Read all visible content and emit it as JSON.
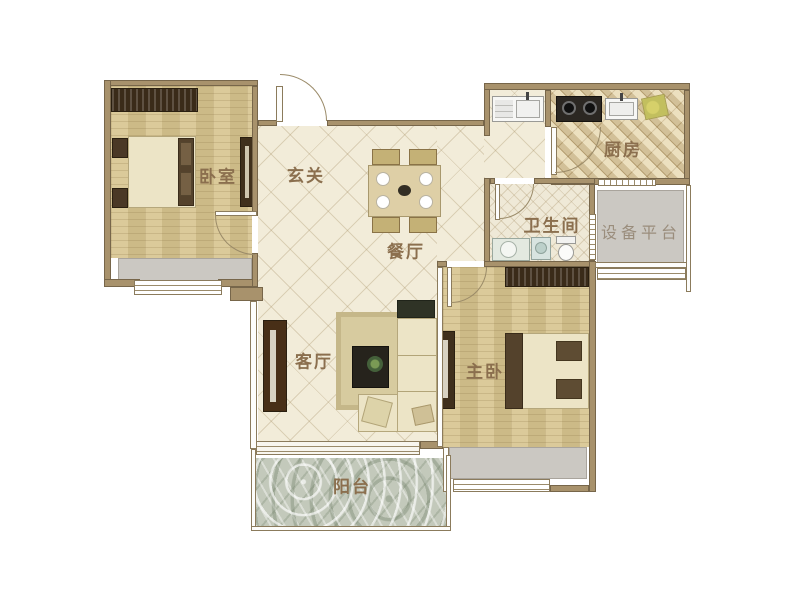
{
  "page": {
    "background": "#ffffff",
    "description": "residential apartment floor plan"
  },
  "labels": {
    "bedroom": "卧室",
    "entry": "玄关",
    "dining": "餐厅",
    "kitchen": "厨房",
    "bathroom": "卫生间",
    "equipment_platform": "设备平台",
    "living": "客厅",
    "master_bedroom": "主卧",
    "balcony": "阳台"
  },
  "colors": {
    "label_text": "#8b6f4e",
    "platform_label_text": "#9a8d7c",
    "wall": "#a8926c",
    "tile_floor": "#f2ecd9",
    "wood_floor": "#d7c48e",
    "kitchen_tile": "#e3d5af",
    "bathroom_tile": "#efe9d7",
    "balcony_stone": "#c3c9bb",
    "bay_window_gray": "#cbc8c2",
    "furniture_dark_brown": "#40301c",
    "furniture_cream": "#ece4c6"
  }
}
